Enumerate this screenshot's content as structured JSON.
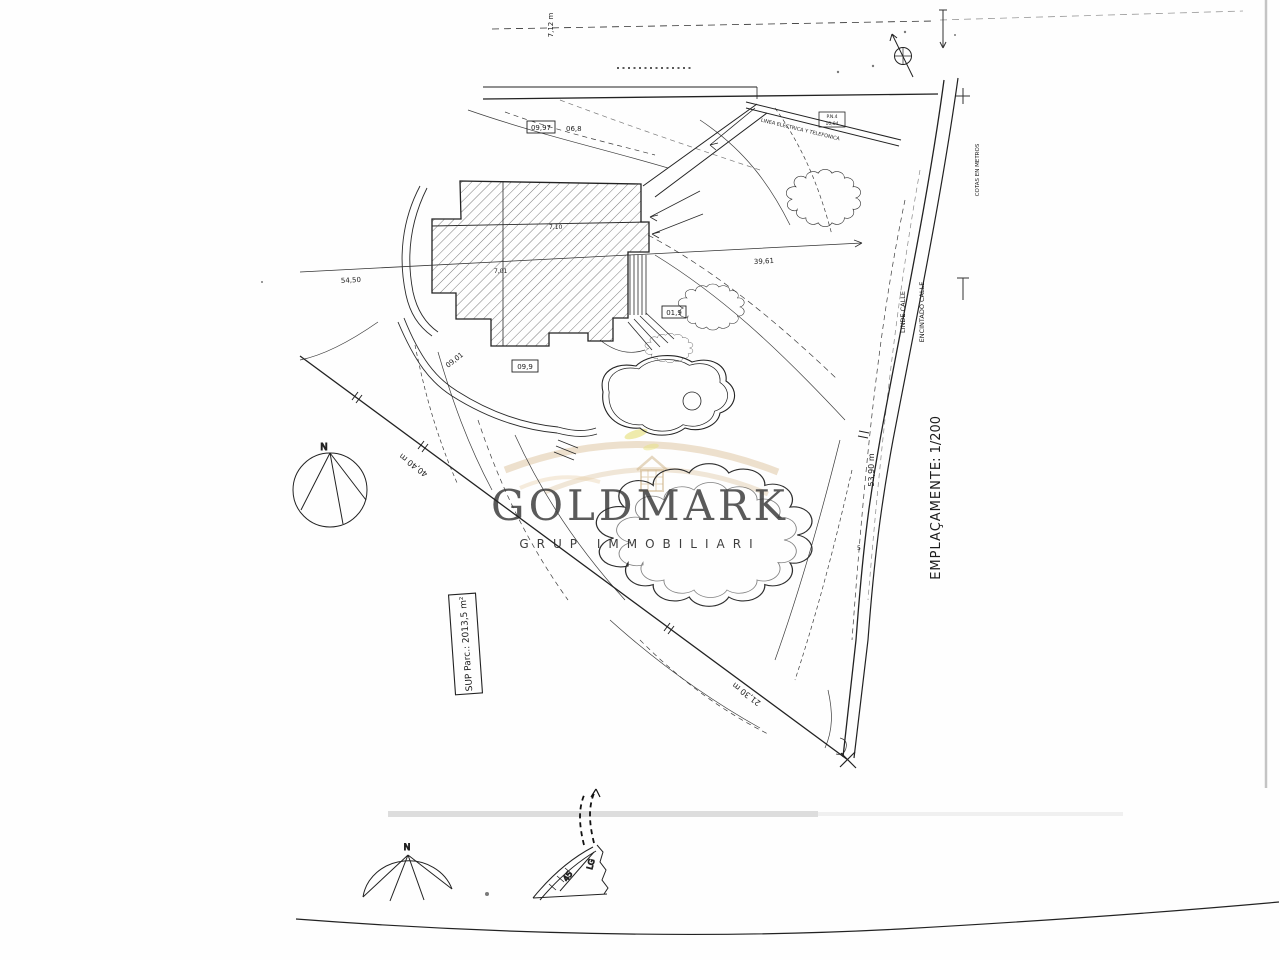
{
  "plan": {
    "title": {
      "name": "EMPLAÇAMENT",
      "scale": "E: 1/200"
    },
    "area_box": {
      "text": "SUP  Parc.: 2013,5 m²"
    },
    "streets": {
      "linde": "LINDE CALLE",
      "encintado": "ENCINTADO CALLE"
    },
    "note_units": "COTAS EN METROS",
    "utility": {
      "line_label": "LINEA ELECTRICA Y TELEFONICA",
      "box_line1": "P.N.4",
      "box_line2": "10,04"
    },
    "dimensions": {
      "southwest": "40,40 m",
      "southeast": "21,30 m",
      "street_side": "53,90 m",
      "top": "7,12 m",
      "cross_left": "54,50",
      "cross_right": "39,61"
    },
    "elevations": {
      "boxed_top": "09,97",
      "top_plain": "06,8",
      "building_a": "7,10",
      "building_b": "7,01",
      "boxed_mid": "01,9",
      "boxed_lower": "09,9",
      "slope": "09,01"
    },
    "compass": {
      "north": "N"
    },
    "station": "5"
  },
  "watermark": {
    "brand": "GOLDMARK",
    "subtitle": "GRUP IMMOBILIARI"
  },
  "bottom_sheet": {
    "north": "N",
    "label_45": "45",
    "label_lg": "LG"
  }
}
